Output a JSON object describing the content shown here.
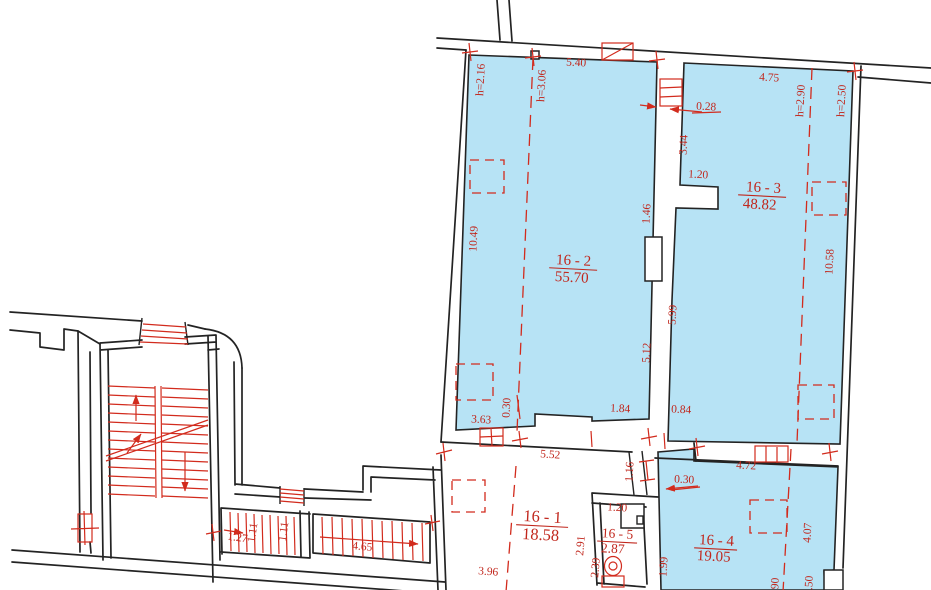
{
  "drawing_type": "architectural floor plan",
  "colors": {
    "room_fill": "#b7e3f5",
    "annotation_red": "#d22b1d",
    "wall": "#232323",
    "background": "#ffffff"
  },
  "rooms": {
    "r16_1": {
      "number": "16 - 1",
      "area": "18.58"
    },
    "r16_2": {
      "number": "16 - 2",
      "area": "55.70"
    },
    "r16_3": {
      "number": "16 - 3",
      "area": "48.82"
    },
    "r16_4": {
      "number": "16 - 4",
      "area": "19.05"
    },
    "r16_5": {
      "number": "16 - 5",
      "area": "2.87"
    }
  },
  "dimensions": {
    "top_width_16_2": "5.40",
    "top_width_16_3": "4.75",
    "height_left": "h=2.16",
    "height_mid_16_2": "h=3.06",
    "height_16_3_a": "h=2.90",
    "height_16_3_b": "h=2.50",
    "wall_thickness": "0.28",
    "seg_344": "3.44",
    "stub_120": "1.20",
    "seg_146": "1.46",
    "side_16_2": "10.49",
    "side_16_3": "10.58",
    "seg_599": "5.99",
    "seg_512": "5.12",
    "seg_184": "1.84",
    "seg_084": "0.84",
    "seg_363": "3.63",
    "offset_030_a": "0.30",
    "top_16_1": "5.52",
    "seg_116": "1.16",
    "top_16_4": "4.72",
    "offset_030_b": "0.30",
    "seg_396": "3.96",
    "stair_127": "1.27",
    "stair_111_a": "1.11",
    "stair_111_b": "1.11",
    "stair_465": "4.65",
    "seg_120_16_5": "1.20",
    "seg_291": "2.91",
    "seg_239": "2.39",
    "seg_199": "1.99",
    "seg_407": "4.07",
    "height_16_4_a": "h=2.90",
    "height_16_4_b": "h=2.50"
  }
}
